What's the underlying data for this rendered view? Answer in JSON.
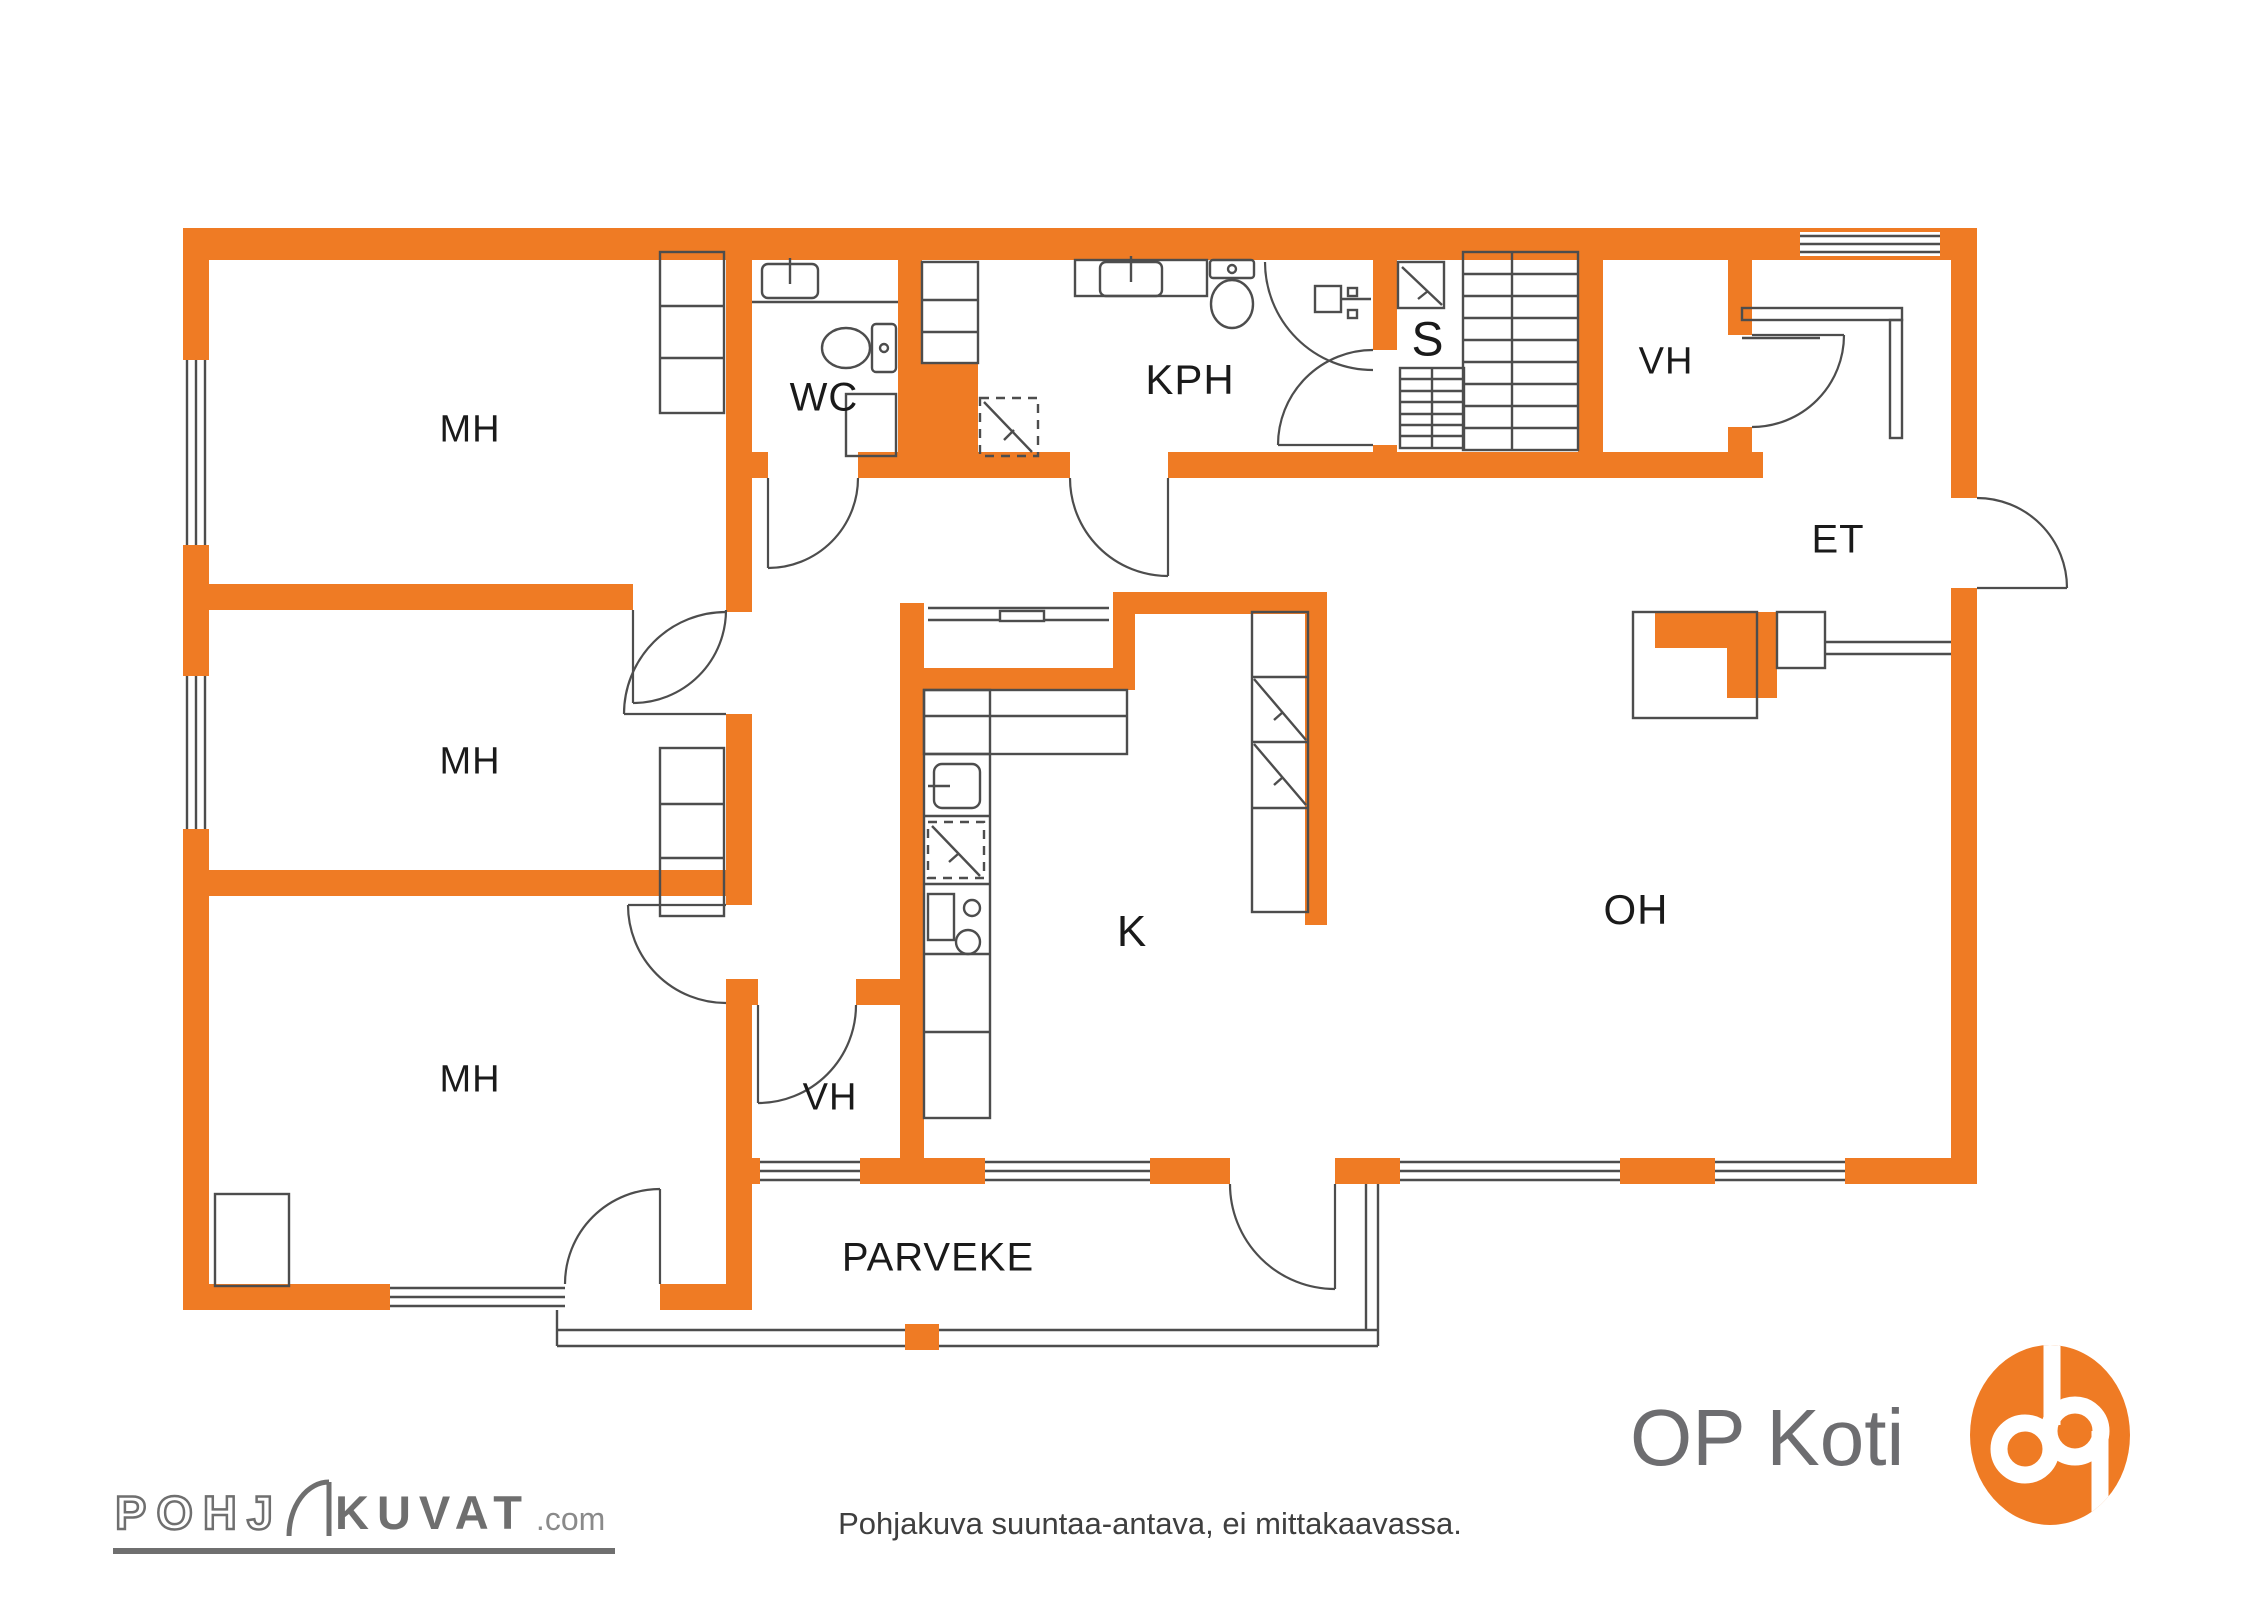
{
  "title": "Pohjakuva / floor plan",
  "colors": {
    "wall_orange": "#EF7B24",
    "line_gray": "#4D4D4D",
    "label_black": "#1A1A1A",
    "logo_gray": "#6F6F6F"
  },
  "rooms": {
    "mh1": {
      "label": "MH"
    },
    "mh2": {
      "label": "MH"
    },
    "mh3": {
      "label": "MH"
    },
    "wc": {
      "label": "WC"
    },
    "kph": {
      "label": "KPH"
    },
    "sauna": {
      "label": "S"
    },
    "vh_top": {
      "label": "VH"
    },
    "vh_bottom": {
      "label": "VH"
    },
    "et": {
      "label": "ET"
    },
    "kitchen": {
      "label": "K"
    },
    "oh": {
      "label": "OH"
    },
    "parveke": {
      "label": "PARVEKE"
    }
  },
  "footer": {
    "disclaimer": "Pohjakuva suuntaa-antava, ei mittakaavassa.",
    "brand": "OP Koti",
    "watermark": {
      "outline": "POHJ",
      "solid": "KUVAT",
      "suffix": ".com"
    }
  }
}
